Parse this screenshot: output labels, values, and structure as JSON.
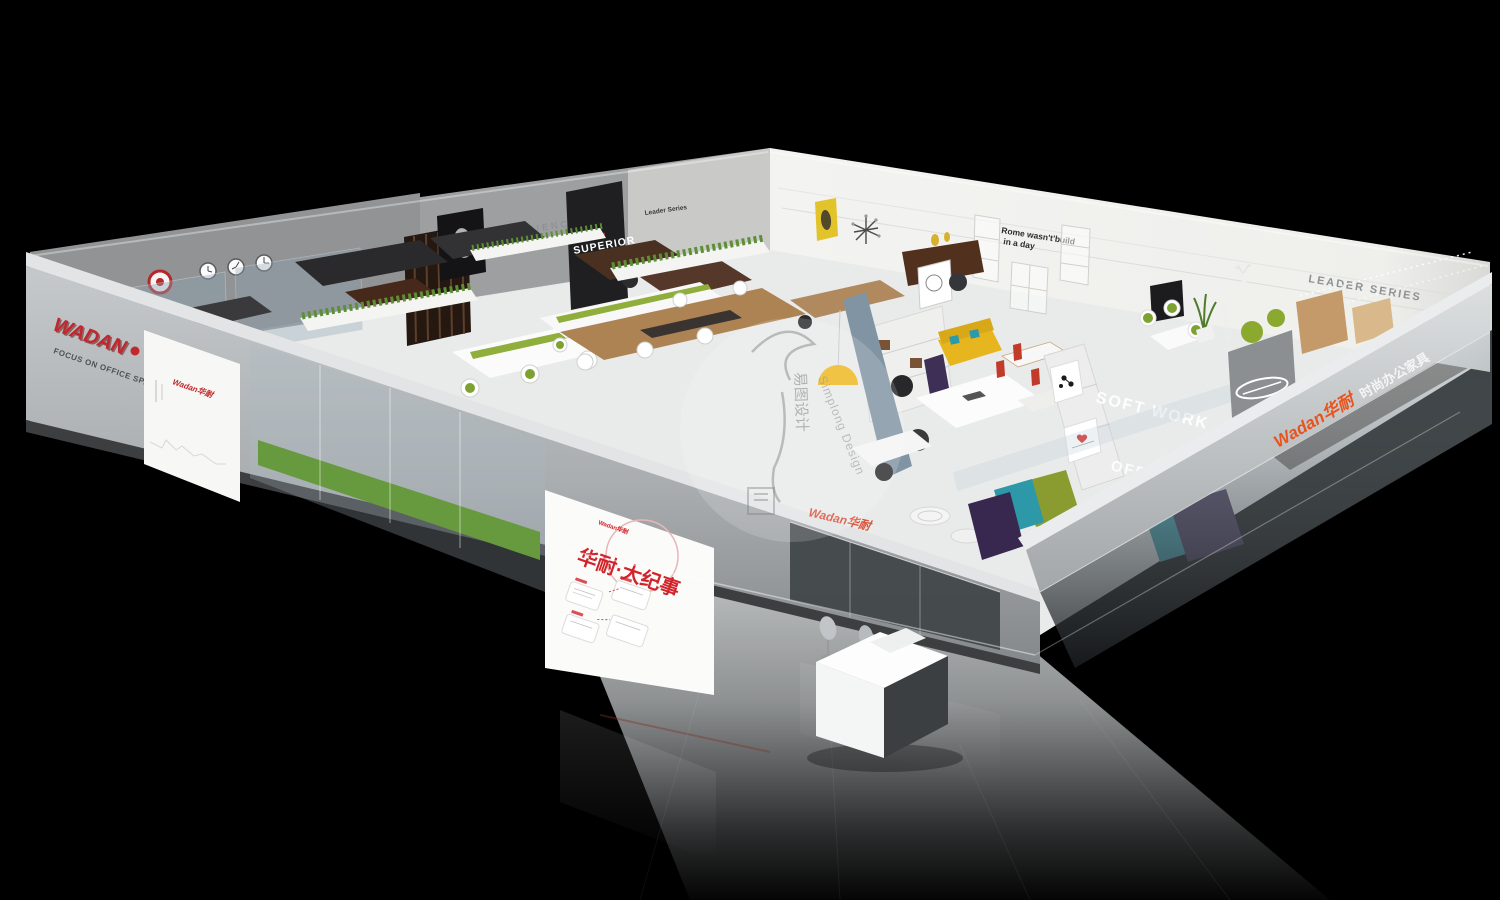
{
  "brand": {
    "name": "WADAN",
    "tagline": "FOCUS ON OFFICE SPACE",
    "cn_name": "Wadan华耐",
    "cn_descriptor": "时尚办公家具",
    "accent_red": "#c1272d",
    "accent_orange": "#e8541e"
  },
  "wall_signs": {
    "superior": "SUPERIOR",
    "experience": "EXPERIENCE",
    "leader_series_small": "Leader Series",
    "leader_series_large": "LEADER SERIES",
    "rome_line1": "Rome wasn't'build",
    "rome_line2": "in a day"
  },
  "glass_signs": {
    "soft_work": "SOFT WORK",
    "office": "OFFICE",
    "fashion_space": "fashion space"
  },
  "lightboxes": {
    "left_brand": "Wadan华耐",
    "timeline_title": "华耐·大纪事",
    "timeline_brand": "Wadan华耐"
  },
  "watermark": {
    "cn": "易图设计",
    "en": "Simplong Design"
  }
}
